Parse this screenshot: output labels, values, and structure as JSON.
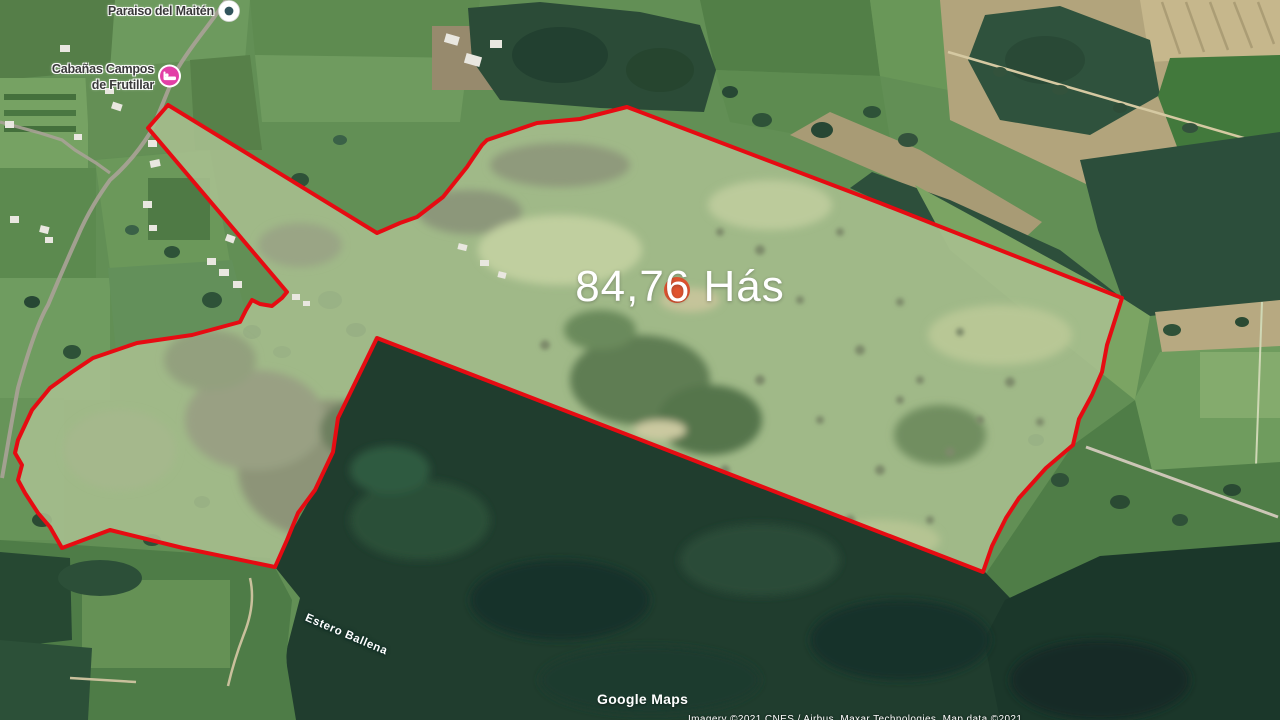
{
  "map": {
    "overlay": {
      "area_label": "84,76 Hás"
    },
    "pois": {
      "paraiso": {
        "label": "Paraiso del Maitén"
      },
      "cabanas": {
        "label_line1": "Cabañas Campos",
        "label_line2": "de Frutillar"
      }
    },
    "water_label": "Estero Ballena",
    "watermark": "Google Maps",
    "attribution": "Imagery ©2021 CNES / Airbus, Maxar Technologies, Map data ©2021",
    "colors": {
      "boundary": "#e60b12",
      "marker_dot": "#e0532f",
      "lodging_pin": "#e23fa6",
      "poi_dot": "#31545c"
    }
  }
}
